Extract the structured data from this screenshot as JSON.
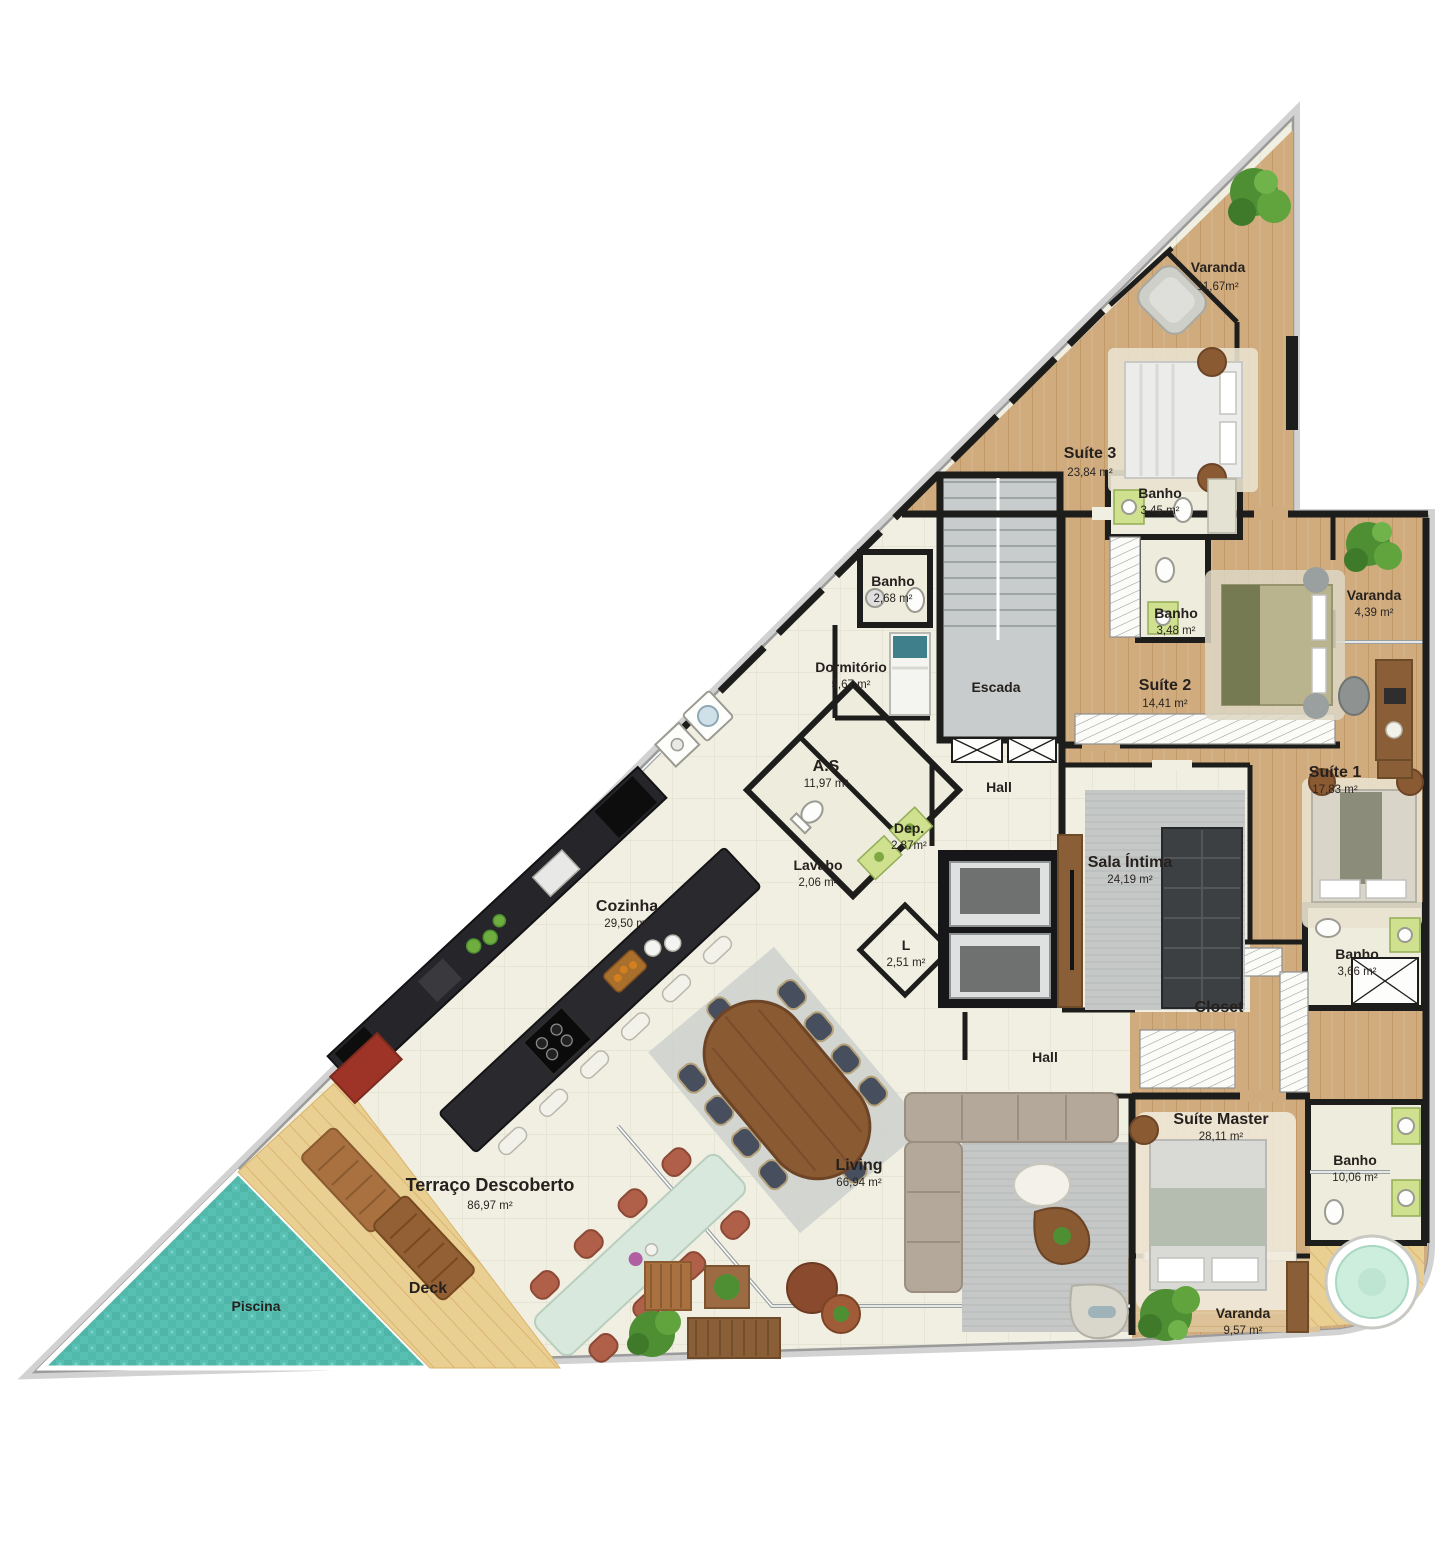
{
  "plan": {
    "colors": {
      "wall": "#1d1d1b",
      "wood_floor": "#cfab7e",
      "light_wood": "#dcc296",
      "tile_floor": "#f0efe2",
      "pool_water": "#57bfb1",
      "deck_wood": "#eacf92",
      "rug_gray": "#c5c8c6",
      "counter_black": "#2a2a2e",
      "plant_green": "#4e8f33"
    },
    "rooms": [
      {
        "id": "varanda-top",
        "name": "Varanda",
        "area": "11,67m²"
      },
      {
        "id": "suite-3",
        "name": "Suíte 3",
        "area": "23,84 m²"
      },
      {
        "id": "banho-suite-3",
        "name": "Banho",
        "area": "3,45 m²"
      },
      {
        "id": "banho-servico",
        "name": "Banho",
        "area": "2,68 m²"
      },
      {
        "id": "dormitorio",
        "name": "Dormitório",
        "area": "5,67 m²"
      },
      {
        "id": "escada",
        "name": "Escada",
        "area": ""
      },
      {
        "id": "banho-suite-2",
        "name": "Banho",
        "area": "3,48 m²"
      },
      {
        "id": "suite-2",
        "name": "Suíte 2",
        "area": "14,41 m²"
      },
      {
        "id": "varanda-suite-2",
        "name": "Varanda",
        "area": "4,39 m²"
      },
      {
        "id": "suite-1",
        "name": "Suíte 1",
        "area": "17,83 m²"
      },
      {
        "id": "area-servico",
        "name": "A.S",
        "area": "11,97 m²"
      },
      {
        "id": "hall-superior",
        "name": "Hall",
        "area": ""
      },
      {
        "id": "deposito",
        "name": "Dep.",
        "area": "2,87m²"
      },
      {
        "id": "lavabo",
        "name": "Lavabo",
        "area": "2,06 m²"
      },
      {
        "id": "l",
        "name": "L",
        "area": "2,51 m²"
      },
      {
        "id": "sala-intima",
        "name": "Sala Íntima",
        "area": "24,19 m²"
      },
      {
        "id": "cozinha",
        "name": "Cozinha",
        "area": "29,50 m²"
      },
      {
        "id": "banho-suite-1",
        "name": "Banho",
        "area": "3,66 m²"
      },
      {
        "id": "closet",
        "name": "Closet",
        "area": ""
      },
      {
        "id": "hall-inferior",
        "name": "Hall",
        "area": ""
      },
      {
        "id": "suite-master",
        "name": "Suíte Master",
        "area": "28,11 m²"
      },
      {
        "id": "banho-master",
        "name": "Banho",
        "area": "10,06 m²"
      },
      {
        "id": "living",
        "name": "Living",
        "area": "66,94 m²"
      },
      {
        "id": "terraco",
        "name": "Terraço Descoberto",
        "area": "86,97 m²"
      },
      {
        "id": "deck",
        "name": "Deck",
        "area": ""
      },
      {
        "id": "piscina",
        "name": "Piscina",
        "area": ""
      },
      {
        "id": "varanda-master",
        "name": "Varanda",
        "area": "9,57 m²"
      }
    ]
  }
}
